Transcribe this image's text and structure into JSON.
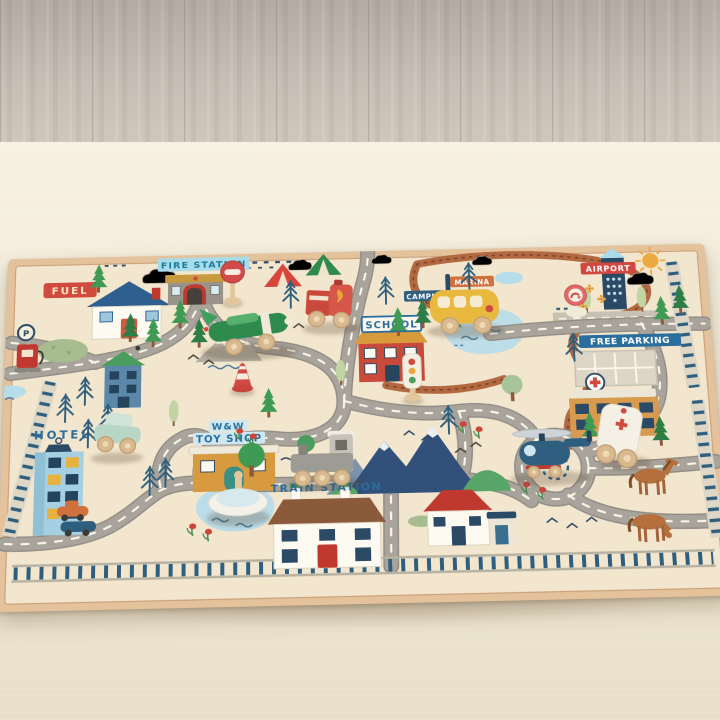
{
  "scene": {
    "description": "Angled photo of a children's city road play rug on a cream carpet beside grey wood-plank flooring, with wooden toy vehicles placed on it",
    "floor": "grey wood planks",
    "carpet": "cream carpet"
  },
  "rug": {
    "labels": {
      "fuel": "FUEL",
      "fire_station": "FIRE STATION",
      "marina": "MARINA",
      "camping": "CAMPING",
      "school": "SCHOOL",
      "airport": "AIRPORT",
      "free_parking": "FREE PARKING",
      "hotel": "HOTEL",
      "toy_shop_line1": "W&W",
      "toy_shop_line2": "TOY SHOP",
      "train_station": "TRAIN STATION",
      "parking_sign": "P"
    },
    "colors": {
      "base": "#f3e6ce",
      "binding": "#e3c29c",
      "road": "#a9a49b",
      "road_dash": "#fbf6ea",
      "dirt_trail": "#b26840",
      "railway_blue": "#2e5f7e",
      "label_blue": "#2a6e9e",
      "label_red": "#d04a3e",
      "water": "#b7dcea"
    },
    "places": [
      "fuel station",
      "fire station",
      "tents",
      "marina-camping signpost",
      "school",
      "airport",
      "runway",
      "free parking lot",
      "hospital",
      "hotel",
      "toy shop",
      "train station",
      "roundabout",
      "pond",
      "lake",
      "mountains",
      "horses"
    ]
  },
  "toys": [
    "green airplane",
    "red fire engine",
    "yellow bus",
    "stop sign",
    "turn arrow sign",
    "traffic light",
    "striped cone",
    "mint green car",
    "grey train engine",
    "navy helicopter",
    "white ambulance",
    "white spinning top"
  ]
}
